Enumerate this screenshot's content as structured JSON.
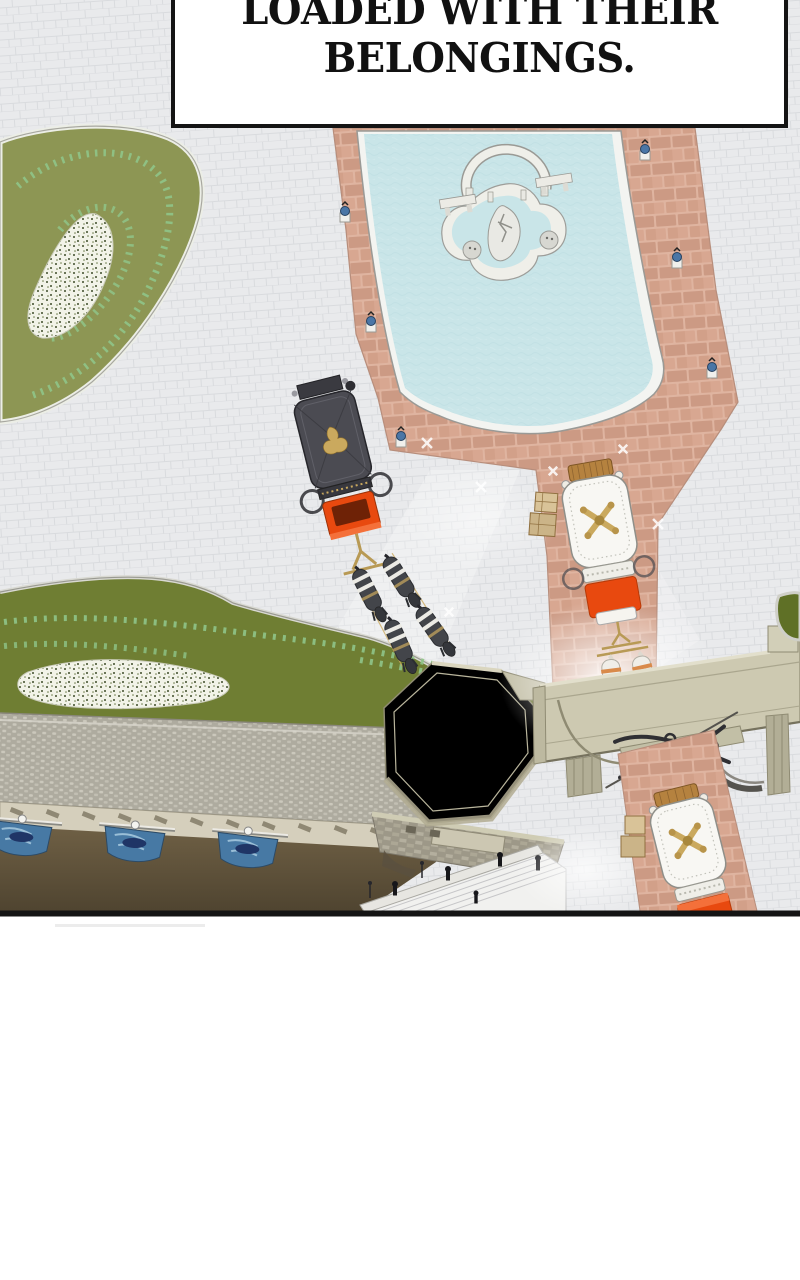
{
  "panel": {
    "type": "webtoon-panel",
    "caption": {
      "lines": [
        "LOADED WITH THEIR",
        "BELONGINGS."
      ]
    }
  },
  "scene": {
    "objects": {
      "pool": "large fountain pool with quatrefoil island and arch sculpture",
      "carriage_dark": "dark royal carriage with gold crest and four dark horses",
      "carriage_white_mid": "white-roofed carriage with gold crest, orange seat, two white horses",
      "carriage_white_bottom": "white-roofed carriage with gold crest and orange seat below the gate",
      "gate": "long beige gate bridge with ornate iron crest",
      "octagon": "octagonal pavilion roof",
      "gardens": "olive lawns with hedge swirls and white flower beds",
      "banners": "three blue banners hanging on the lower wall",
      "stairs": "wide white stairway with small figures"
    }
  },
  "colors": {
    "page_bg": "#ffffff",
    "panel_border": "#141414",
    "plaza": "#e9eaec",
    "plaza_joint": "#d4d5d9",
    "path_pink": "#dfb4a0",
    "path_brick": "#cc9a84",
    "path_brick2": "#d8a791",
    "path_edge": "#b78e7c",
    "pool_rim": "#f3f4f1",
    "pool_water": "#c9e5e8",
    "island_white": "#efefe9",
    "lawn_light": "#8d9654",
    "lawn_dark": "#6f7e33",
    "lawn_dark2": "#5f7026",
    "hedge": "#8fc488",
    "flowerbed": "#f2f3e8",
    "flower_speck": "#3e4d2a",
    "roof_beige": "#cdc9b1",
    "roof_edge": "#8f8b73",
    "cobble_base": "#aeab9f",
    "cobble_stone": "#cbc8bc",
    "band_beige": "#d5cfbc",
    "band_slot": "#8f8874",
    "banner_blue": "#4779a4",
    "banner_navy": "#1f3566",
    "water_brown": "#6f6045",
    "water_brown_dark": "#4f4430",
    "stone_wall": "#9d9888",
    "stair_white": "#f1f1ef",
    "stair_line": "#c6c6c8",
    "carriage_dark": "#4b4b52",
    "carriage_gold": "#caa95e",
    "seat_orange": "#e8490f",
    "seat_orange_dark": "#b63a08",
    "carriage_white": "#f8f7f3",
    "luggage_brown": "#b5823f",
    "horse_dark": "#43454a",
    "horse_white": "#f0eee8",
    "strap_tan": "#d98a4a",
    "lamp_blue": "#4a76a6"
  }
}
